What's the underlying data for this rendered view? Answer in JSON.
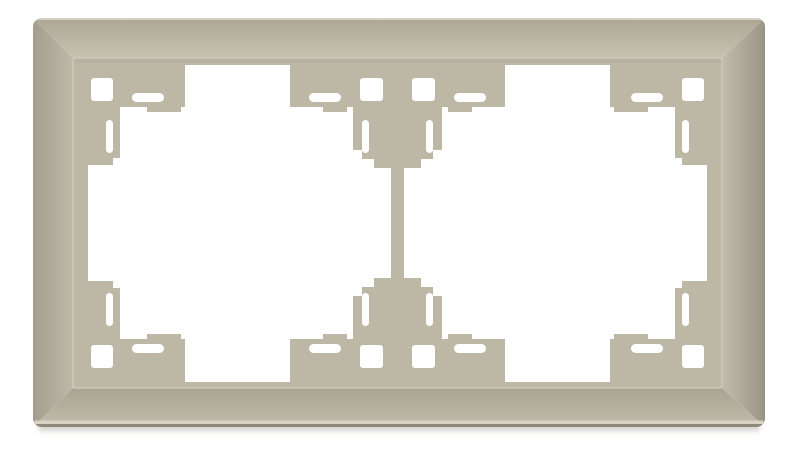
{
  "product": {
    "description": "Product photo: beige double (2-gang) wall switch frame, front view, on white background",
    "color_name": "beige / cream",
    "gangs": 2
  },
  "colors": {
    "background": "#ffffff",
    "frame_base": "#bdb7a6",
    "bevel_light": "#c8c2b1",
    "bevel_dark": "#9a9585",
    "top_edge_highlight": "#d5d0c2",
    "bottom_edge_highlight": "#d7d3c5",
    "bottom_edge_dark": "#8e8979",
    "inner_rim_highlight": "#cdc8b7",
    "cutout": "#ffffff"
  },
  "canvas": {
    "width": 800,
    "height": 449
  },
  "gradients": [
    {
      "id": "gBevTop",
      "x1": 0,
      "y1": 18,
      "x2": 0,
      "y2": 58,
      "stops": [
        [
          "0",
          "#aca695"
        ],
        [
          "1",
          "#c8c2b1"
        ]
      ]
    },
    {
      "id": "gBevBot",
      "x1": 0,
      "y1": 388,
      "x2": 0,
      "y2": 427,
      "stops": [
        [
          "0",
          "#a9a392"
        ],
        [
          "1",
          "#c2bcab"
        ]
      ]
    },
    {
      "id": "gBevLeft",
      "x1": 33,
      "y1": 0,
      "x2": 73,
      "y2": 0,
      "stops": [
        [
          "0",
          "#a39d8d"
        ],
        [
          "1",
          "#bfb9a8"
        ]
      ]
    },
    {
      "id": "gBevRight",
      "x1": 722,
      "y1": 0,
      "x2": 765,
      "y2": 0,
      "stops": [
        [
          "0",
          "#c2bcab"
        ],
        [
          "1",
          "#9a9585"
        ]
      ]
    }
  ],
  "underlay": [
    {
      "t": "rect",
      "name": "drop-shadow",
      "x": 38,
      "y": 422,
      "w": 722,
      "h": 9,
      "rx": 4,
      "fill": "rgba(110,105,92,0.30)",
      "filter": "url(#blur1)"
    }
  ],
  "symbols": {
    "outer_tab": [
      {
        "t": "path",
        "name": "tab-column",
        "d": "M88,58 L120,58 L120,158 L113,158 L113,165 L88,165 Z",
        "fill": "#bdb7a6"
      },
      {
        "t": "rect",
        "name": "tab-arm",
        "x": 88,
        "y": 58,
        "w": 97,
        "h": 49,
        "fill": "#bdb7a6"
      },
      {
        "t": "rect",
        "name": "tab-foot",
        "x": 147,
        "y": 107,
        "w": 34,
        "h": 5,
        "fill": "#bdb7a6"
      },
      {
        "t": "rect",
        "name": "mount-hole-square",
        "x": 91,
        "y": 78,
        "w": 22,
        "h": 23,
        "rx": 3,
        "fill": "#ffffff"
      },
      {
        "t": "rect",
        "name": "mount-slot-horizontal",
        "x": 132,
        "y": 93,
        "w": 32,
        "h": 9,
        "rx": 4.5,
        "fill": "#ffffff"
      },
      {
        "t": "rect",
        "name": "mount-slot-vertical",
        "x": 106,
        "y": 120,
        "w": 7,
        "h": 33,
        "rx": 3.5,
        "fill": "#ffffff"
      }
    ],
    "center_half": [
      {
        "t": "rect",
        "name": "divider-arm",
        "x": 290,
        "y": 58,
        "w": 215,
        "h": 49,
        "fill": "#bdb7a6"
      },
      {
        "t": "rect",
        "name": "divider-column",
        "x": 353,
        "y": 58,
        "w": 89,
        "h": 92,
        "fill": "#bdb7a6"
      },
      {
        "t": "rect",
        "name": "divider-step-1",
        "x": 362,
        "y": 150,
        "w": 71,
        "h": 9,
        "fill": "#bdb7a6"
      },
      {
        "t": "rect",
        "name": "divider-step-2",
        "x": 374,
        "y": 159,
        "w": 47,
        "h": 9,
        "fill": "#bdb7a6"
      },
      {
        "t": "rect",
        "name": "divider-bar",
        "x": 391,
        "y": 167,
        "w": 13,
        "h": 57,
        "fill": "#bdb7a6"
      },
      {
        "t": "rect",
        "name": "tab-foot",
        "x": 323,
        "y": 107,
        "w": 24,
        "h": 5,
        "fill": "#bdb7a6"
      },
      {
        "t": "rect",
        "name": "tab-foot",
        "x": 448,
        "y": 107,
        "w": 24,
        "h": 5,
        "fill": "#bdb7a6"
      },
      {
        "t": "rect",
        "name": "mount-hole-square",
        "x": 360,
        "y": 78,
        "w": 23,
        "h": 23,
        "rx": 3,
        "fill": "#ffffff"
      },
      {
        "t": "rect",
        "name": "mount-hole-square",
        "x": 412,
        "y": 78,
        "w": 23,
        "h": 23,
        "rx": 3,
        "fill": "#ffffff"
      },
      {
        "t": "rect",
        "name": "mount-slot-horizontal",
        "x": 309,
        "y": 93,
        "w": 32,
        "h": 9,
        "rx": 4.5,
        "fill": "#ffffff"
      },
      {
        "t": "rect",
        "name": "mount-slot-horizontal",
        "x": 454,
        "y": 93,
        "w": 32,
        "h": 9,
        "rx": 4.5,
        "fill": "#ffffff"
      },
      {
        "t": "rect",
        "name": "mount-slot-vertical",
        "x": 362,
        "y": 120,
        "w": 7,
        "h": 33,
        "rx": 3.5,
        "fill": "#ffffff"
      },
      {
        "t": "rect",
        "name": "mount-slot-vertical",
        "x": 426,
        "y": 120,
        "w": 7,
        "h": 33,
        "rx": 3.5,
        "fill": "#ffffff"
      }
    ]
  },
  "frame_shapes": [
    {
      "t": "rect",
      "name": "frame-floor",
      "x": 73,
      "y": 58,
      "w": 649,
      "h": 330,
      "rx": 4,
      "fill": "#bdb7a6"
    },
    {
      "t": "rect",
      "name": "window-opening-left",
      "x": 88,
      "y": 65,
      "w": 303,
      "h": 317,
      "rx": 3,
      "fill": "#ffffff"
    },
    {
      "t": "rect",
      "name": "window-opening-right",
      "x": 404,
      "y": 65,
      "w": 303,
      "h": 317,
      "rx": 3,
      "fill": "#ffffff"
    },
    {
      "t": "use",
      "symbol": "outer_tab",
      "name": "mount-tab-group-top-left",
      "transform": ""
    },
    {
      "t": "use",
      "symbol": "outer_tab",
      "name": "mount-tab-group-top-right",
      "transform": "translate(795,0) scale(-1,1)"
    },
    {
      "t": "use",
      "symbol": "outer_tab",
      "name": "mount-tab-group-bottom-left",
      "transform": "translate(0,446) scale(1,-1)"
    },
    {
      "t": "use",
      "symbol": "outer_tab",
      "name": "mount-tab-group-bottom-right",
      "transform": "translate(795,446) scale(-1,-1)"
    },
    {
      "t": "use",
      "symbol": "center_half",
      "name": "center-divider-top",
      "transform": ""
    },
    {
      "t": "use",
      "symbol": "center_half",
      "name": "center-divider-bottom",
      "transform": "translate(0,446) scale(1,-1)"
    },
    {
      "t": "rect",
      "name": "floor-top-shade",
      "x": 73,
      "y": 58,
      "w": 649,
      "h": 5,
      "fill": "rgba(90,85,70,0.06)"
    },
    {
      "t": "polygon",
      "name": "bevel-top",
      "points": "33,18 765,18 722,58 73,58",
      "fill": "url(#gBevTop)"
    },
    {
      "t": "polygon",
      "name": "bevel-bottom",
      "points": "33,427 73,388 722,388 765,427",
      "fill": "url(#gBevBot)"
    },
    {
      "t": "polygon",
      "name": "bevel-left",
      "points": "33,18 73,58 73,388 33,427",
      "fill": "url(#gBevLeft)"
    },
    {
      "t": "polygon",
      "name": "bevel-right",
      "points": "765,18 765,427 722,388 722,58",
      "fill": "url(#gBevRight)"
    },
    {
      "t": "rect",
      "name": "inner-rim-highlight",
      "x": 73,
      "y": 58,
      "w": 649,
      "h": 330,
      "rx": 3,
      "fill": "none",
      "stroke": "#cdc8b7",
      "sw": 1.5
    },
    {
      "t": "rect",
      "name": "outer-edge-top-highlight",
      "x": 33,
      "y": 18,
      "w": 732,
      "h": 2,
      "fill": "#d5d0c2"
    },
    {
      "t": "rect",
      "name": "outer-edge-bottom-highlight",
      "x": 33,
      "y": 420.5,
      "w": 732,
      "h": 3.5,
      "fill": "#d7d3c5"
    },
    {
      "t": "rect",
      "name": "outer-edge-bottom-dark",
      "x": 33,
      "y": 424,
      "w": 732,
      "h": 3,
      "fill": "#8e8979"
    },
    {
      "t": "rect",
      "name": "outer-edge-left-dark",
      "x": 33,
      "y": 18,
      "w": 1.6,
      "h": 409,
      "fill": "#a39d8d"
    },
    {
      "t": "rect",
      "name": "outer-edge-right-dark",
      "x": 763.4,
      "y": 18,
      "w": 1.6,
      "h": 409,
      "fill": "#96917f"
    }
  ]
}
